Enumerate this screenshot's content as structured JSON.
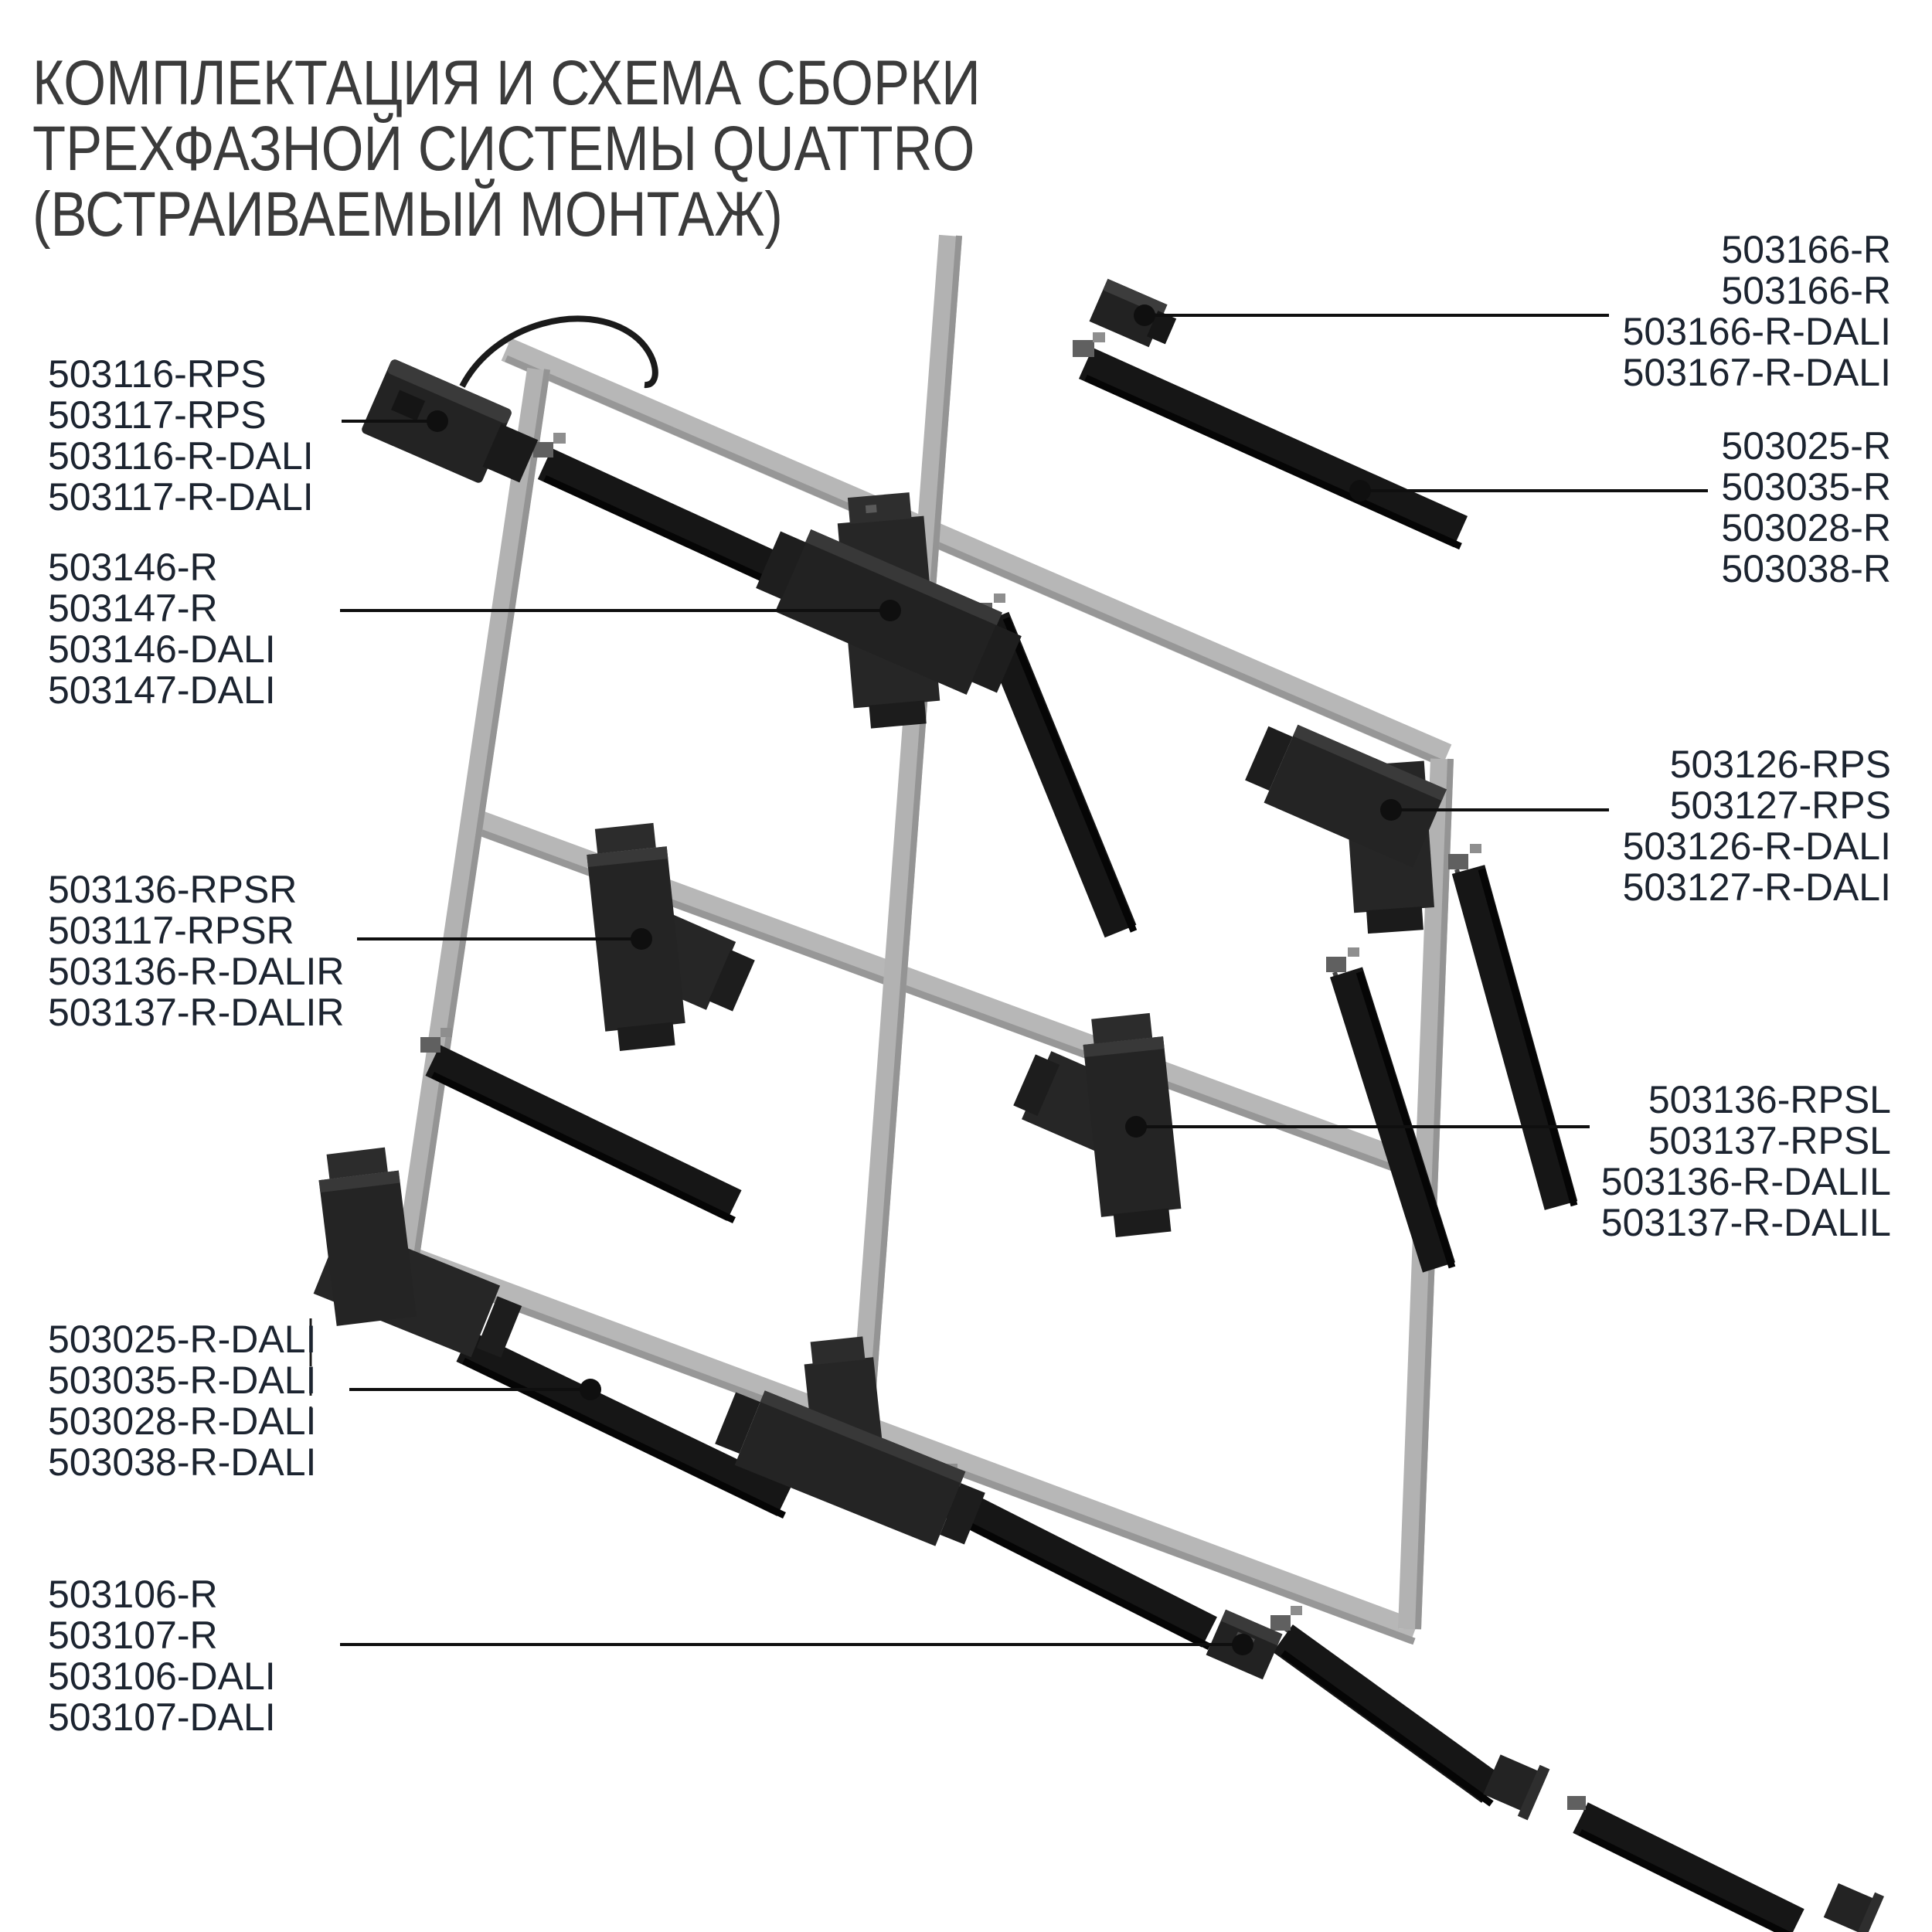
{
  "title": {
    "line1": "КОМПЛЕКТАЦИЯ И СХЕМА СБОРКИ",
    "line2": "ТРЕХФАЗНОЙ СИСТЕМЫ QUATTRO",
    "line3": "(ВСТРАИВАЕМЫЙ МОНТАЖ)"
  },
  "colors": {
    "background": "#ffffff",
    "title_text": "#3b3b3b",
    "label_text": "#1c2430",
    "leader_line": "#0f0f0f",
    "frame_gray": "#b7b7b7",
    "track_black": "#161616"
  },
  "part_groups": [
    {
      "id": "power-feed-connector",
      "side": "left",
      "lines": [
        "503116-RPS",
        "503117-RPS",
        "503116-R-DALI",
        "503117-R-DALI"
      ]
    },
    {
      "id": "straight-mini-joiner-top",
      "side": "right",
      "lines": [
        "503166-R",
        "503166-R",
        "503166-R-DALI",
        "503167-R-DALI"
      ]
    },
    {
      "id": "track-segments",
      "side": "right",
      "lines": [
        "503025-R",
        "503035-R",
        "503028-R",
        "503038-R"
      ]
    },
    {
      "id": "x-connector",
      "side": "left",
      "lines": [
        "503146-R",
        "503147-R",
        "503146-DALI",
        "503147-DALI"
      ]
    },
    {
      "id": "corner-connector-right",
      "side": "right",
      "lines": [
        "503126-RPS",
        "503127-RPS",
        "503126-R-DALI",
        "503127-R-DALI"
      ]
    },
    {
      "id": "t-connector-right-feed",
      "side": "left",
      "lines": [
        "503136-RPSR",
        "503117-RPSR",
        "503136-R-DALIR",
        "503137-R-DALIR"
      ]
    },
    {
      "id": "t-connector-left-feed",
      "side": "right",
      "lines": [
        "503136-RPSL",
        "503137-RPSL",
        "503136-R-DALIL",
        "503137-R-DALIL"
      ]
    },
    {
      "id": "track-segments-dali",
      "side": "left",
      "lines": [
        "503025-R-DALI",
        "503035-R-DALI",
        "503028-R-DALI",
        "503038-R-DALI"
      ]
    },
    {
      "id": "straight-joiner-bottom",
      "side": "left",
      "lines": [
        "503106-R",
        "503107-R",
        "503106-DALI",
        "503107-DALI"
      ]
    }
  ]
}
